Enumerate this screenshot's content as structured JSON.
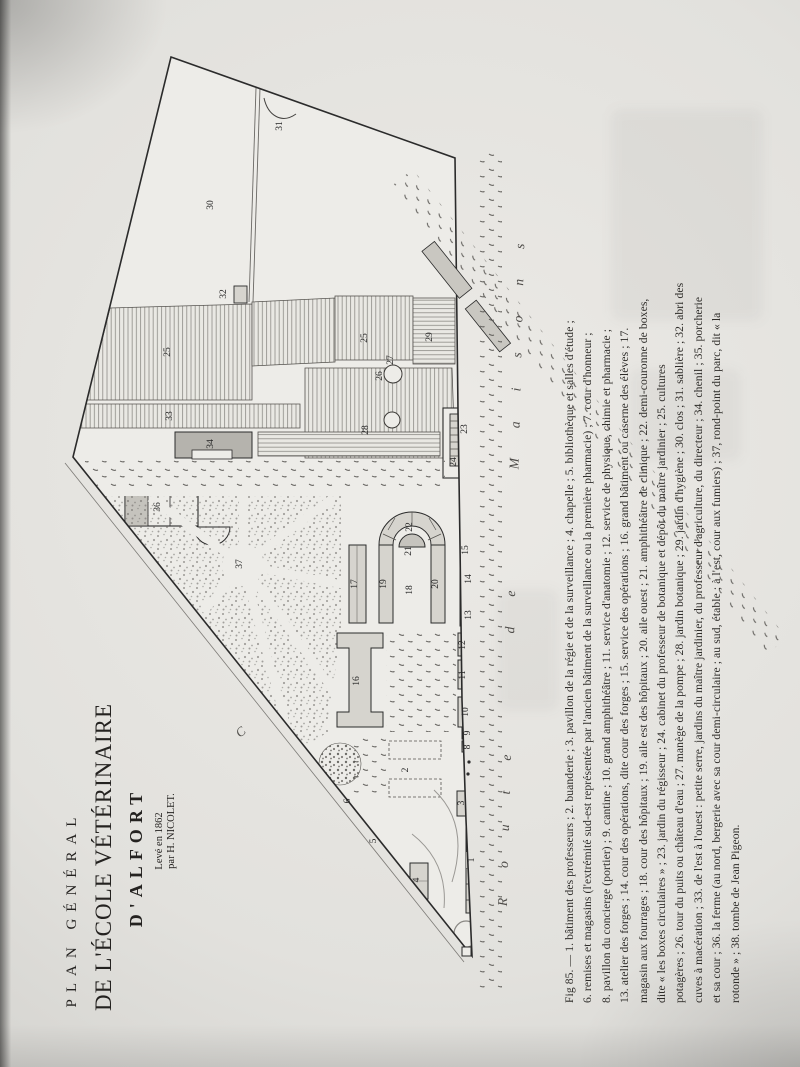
{
  "title_block": {
    "line1": "PLAN GÉNÉRAL",
    "line2": "DE L'ÉCOLE VÉTÉRINAIRE",
    "line3": "D'ALFORT",
    "line4": "Levé en 1862",
    "line5": "par H. NICOLET."
  },
  "caption": {
    "lines": [
      "Fig 85. — 1. bâtiment des professeurs ; 2. buanderie ; 3. pavillon de la régie et de la surveillance ; 4. chapelle ; 5. bibliothèque et salles d'étude ;",
      "6. remises et magasins (l'extrémité sud-est représentée par l'ancien bâtiment de la surveillance ou la première pharmacie) ; 7. cour d'honneur ;",
      "8. pavillon du concierge (portier) ; 9. cantine ; 10. grand amphithéâtre ; 11. service d'anatomie ; 12. service de physique, chimie et pharmacie ;",
      "13. atelier des forges ; 14. cour des opérations, dite cour des forges ; 15. service des opérations ; 16. grand bâtiment ou caserne des élèves ; 17.",
      "magasin aux fourrages ; 18. cour des hôpitaux ; 19. aile est des hôpitaux ; 20. aile ouest ; 21. amphithéâtre de clinique ; 22. demi-couronne de boxes,",
      "dite « les boxes circulaires » ; 23. jardin du régisseur ; 24. cabinet du professeur de botanique et dépôt du maître jardinier ; 25. cultures",
      "potagères ; 26. tour du puits ou château d'eau ; 27. manège de la pompe ; 28. jardin botanique ; 29. jardin d'hygiène ; 30. clos ; 31. sablière ; 32. abri des",
      "cuves à macération ; 33. de l'est à l'ouest : petite serre, jardins du maître jardinier, du professeur d'agriculture, du directeur ; 34. chenil ; 35. porcherie",
      "et sa cour ; 36. la ferme (au nord, bergerie avec sa cour demi-circulaire ; au sud, étable ; à l'est, cour aux fumiers) ; 37, rond-point du parc, dit « la",
      "rotonde » ; 38. tombe de Jean Pigeon."
    ]
  },
  "plan": {
    "road_label": "Route de Maisons",
    "road2_letter": "C",
    "ink": "#2b2b2b",
    "paper": "#edece8",
    "building_fill": "#d6d4ce",
    "dark_fill": "#b5b3ad",
    "labels": [
      {
        "n": "30",
        "x": 213,
        "y": 205
      },
      {
        "n": "31",
        "x": 282,
        "y": 126
      },
      {
        "n": "32",
        "x": 226,
        "y": 294
      },
      {
        "n": "25",
        "x": 170,
        "y": 352
      },
      {
        "n": "25",
        "x": 367,
        "y": 338
      },
      {
        "n": "29",
        "x": 432,
        "y": 337
      },
      {
        "n": "27",
        "x": 393,
        "y": 360
      },
      {
        "n": "26",
        "x": 382,
        "y": 376
      },
      {
        "n": "28",
        "x": 368,
        "y": 430
      },
      {
        "n": "33",
        "x": 172,
        "y": 416
      },
      {
        "n": "34",
        "x": 213,
        "y": 444
      },
      {
        "n": "36",
        "x": 160,
        "y": 507
      },
      {
        "n": "23",
        "x": 467,
        "y": 429
      },
      {
        "n": "24",
        "x": 456,
        "y": 462
      },
      {
        "n": "37",
        "x": 242,
        "y": 564
      },
      {
        "n": "17",
        "x": 357,
        "y": 584
      },
      {
        "n": "19",
        "x": 386,
        "y": 584
      },
      {
        "n": "18",
        "x": 412,
        "y": 590
      },
      {
        "n": "20",
        "x": 438,
        "y": 584
      },
      {
        "n": "21",
        "x": 411,
        "y": 551
      },
      {
        "n": "22",
        "x": 412,
        "y": 527
      },
      {
        "n": "15",
        "x": 468,
        "y": 550
      },
      {
        "n": "14",
        "x": 471,
        "y": 579
      },
      {
        "n": "13",
        "x": 471,
        "y": 615
      },
      {
        "n": "16",
        "x": 359,
        "y": 681
      },
      {
        "n": "12",
        "x": 465,
        "y": 645
      },
      {
        "n": "11",
        "x": 465,
        "y": 675
      },
      {
        "n": "10",
        "x": 468,
        "y": 712
      },
      {
        "n": "9",
        "x": 470,
        "y": 733
      },
      {
        "n": "8",
        "x": 470,
        "y": 747
      },
      {
        "n": "2",
        "x": 408,
        "y": 770
      },
      {
        "n": "6",
        "x": 350,
        "y": 801
      },
      {
        "n": "3",
        "x": 464,
        "y": 803
      },
      {
        "n": "5",
        "x": 376,
        "y": 841
      },
      {
        "n": "4",
        "x": 419,
        "y": 880
      },
      {
        "n": "1",
        "x": 474,
        "y": 860
      }
    ]
  }
}
